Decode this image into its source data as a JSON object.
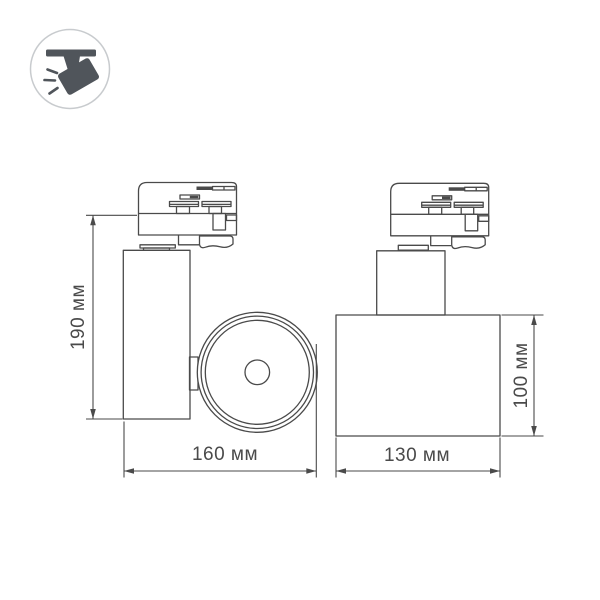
{
  "title": "Track light fixture dimensional drawing",
  "colors": {
    "background": "#ffffff",
    "line": "#4a4a4a",
    "dim_text": "#4a4a4a",
    "icon_fill": "#50555b",
    "icon_ring": "#c8cbce"
  },
  "icon": {
    "name": "track-spotlight"
  },
  "views": {
    "side": {
      "name": "side-view",
      "height_label": "190 мм",
      "width_label": "160 мм"
    },
    "front": {
      "name": "front-view",
      "width_label": "130 мм",
      "height_label": "100 мм"
    }
  }
}
